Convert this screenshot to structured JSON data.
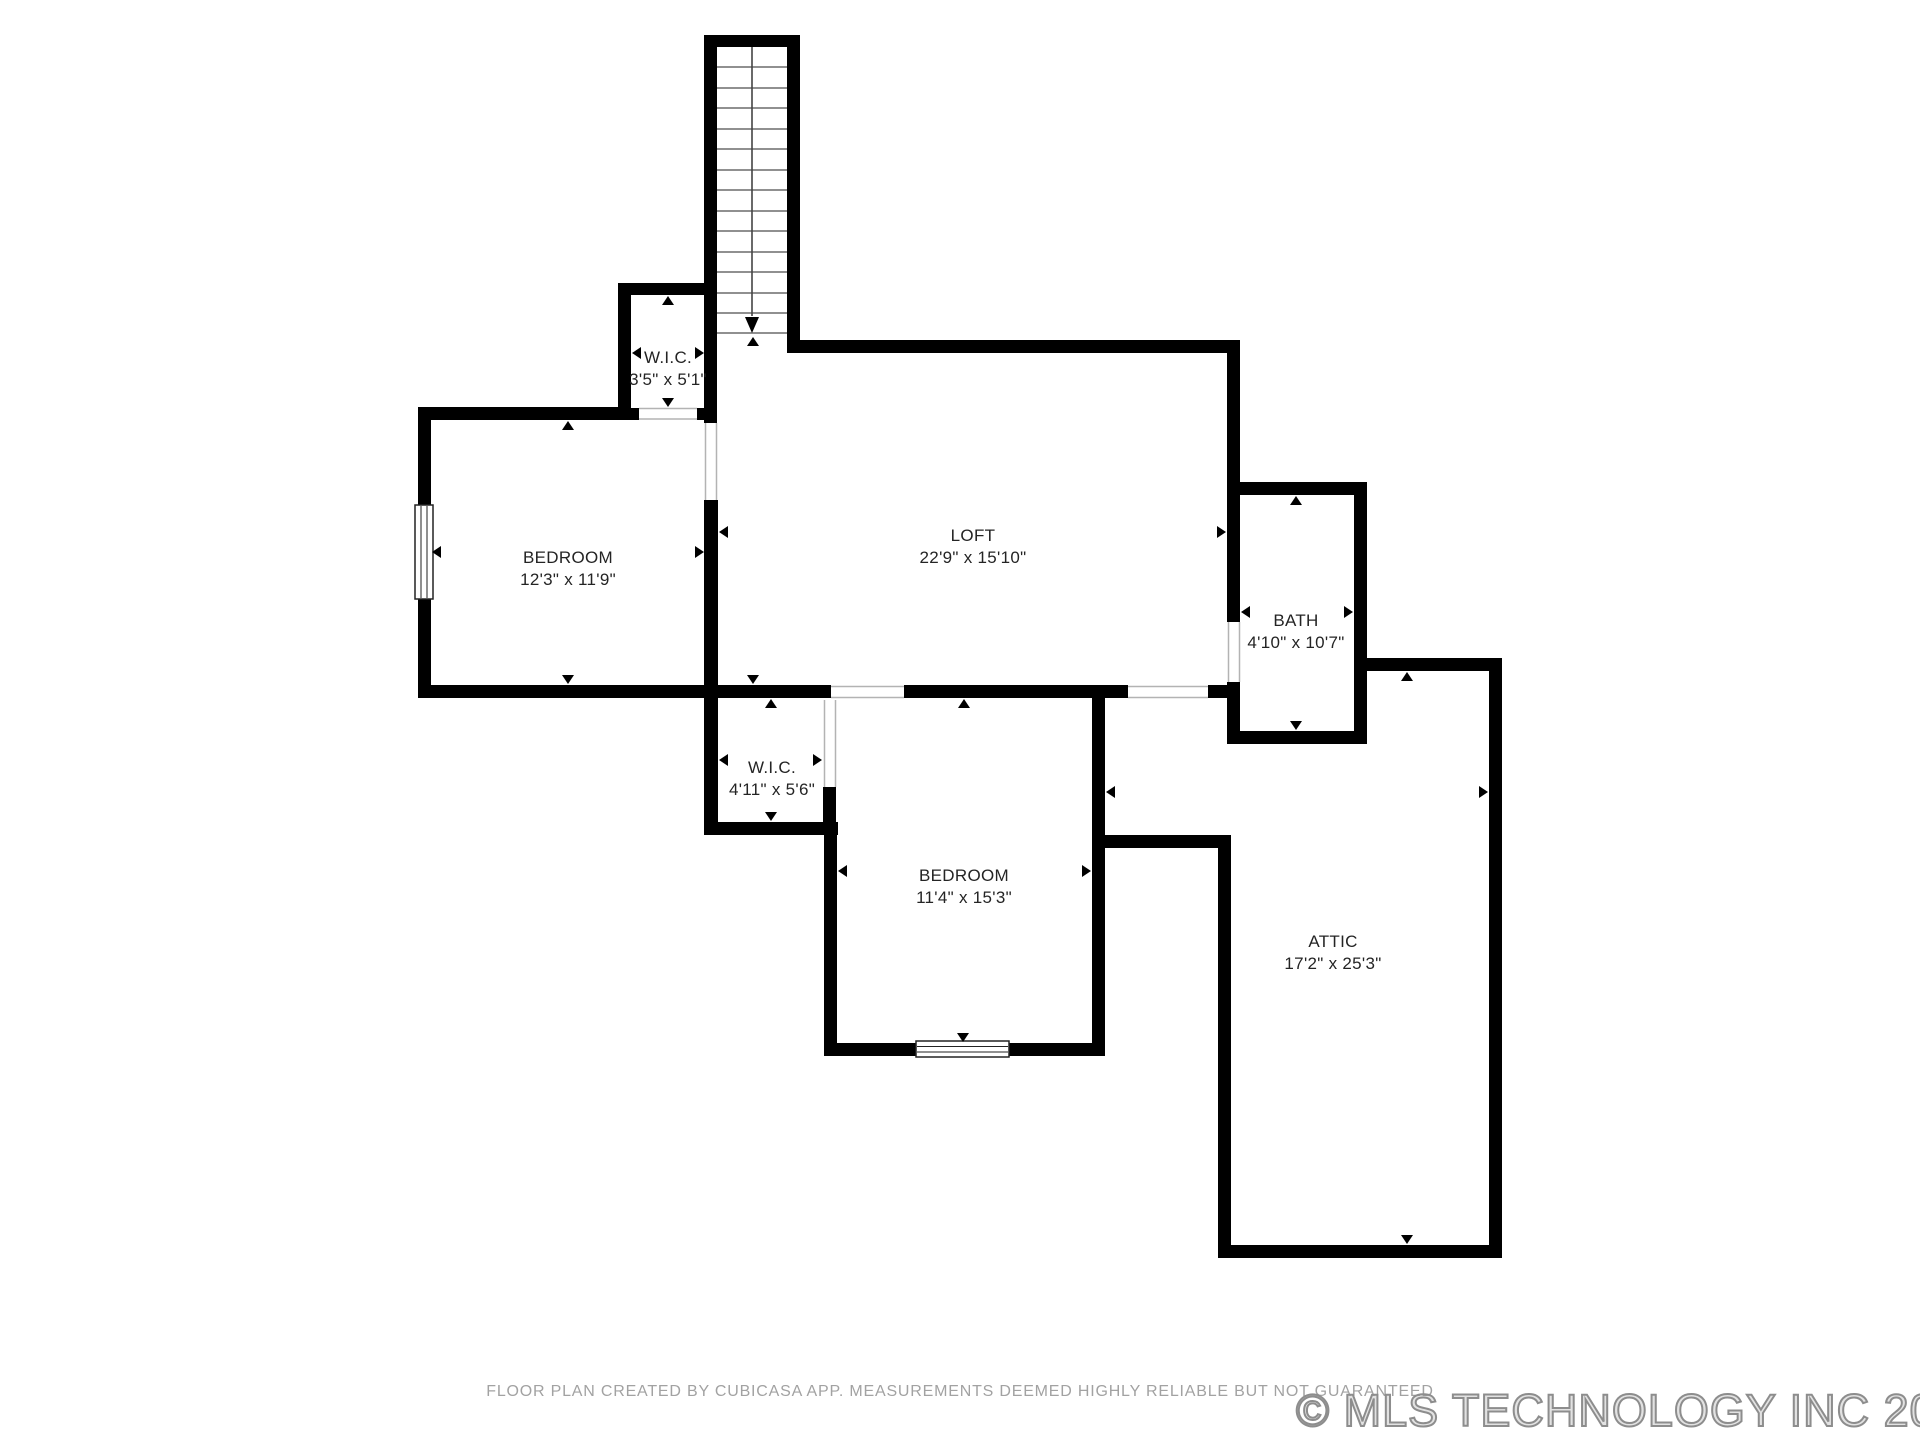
{
  "rooms": [
    {
      "name": "W.I.C.",
      "dims": "3'5\" x 5'1\""
    },
    {
      "name": "BEDROOM",
      "dims": "12'3\" x 11'9\""
    },
    {
      "name": "LOFT",
      "dims": "22'9\" x 15'10\""
    },
    {
      "name": "BATH",
      "dims": "4'10\" x 10'7\""
    },
    {
      "name": "W.I.C.",
      "dims": "4'11\" x 5'6\""
    },
    {
      "name": "BEDROOM",
      "dims": "11'4\" x 15'3\""
    },
    {
      "name": "ATTIC",
      "dims": "17'2\" x 25'3\""
    }
  ],
  "footer": {
    "disclaimer": "FLOOR PLAN CREATED BY CUBICASA APP. MEASUREMENTS DEEMED HIGHLY RELIABLE BUT NOT GUARANTEED",
    "watermark": "© MLS TECHNOLOGY INC 2025"
  },
  "colors": {
    "wall": "#000000",
    "label_text": "#242424",
    "disclaimer_text": "#a2a2a2",
    "watermark_gray": "#8d8d8d"
  }
}
